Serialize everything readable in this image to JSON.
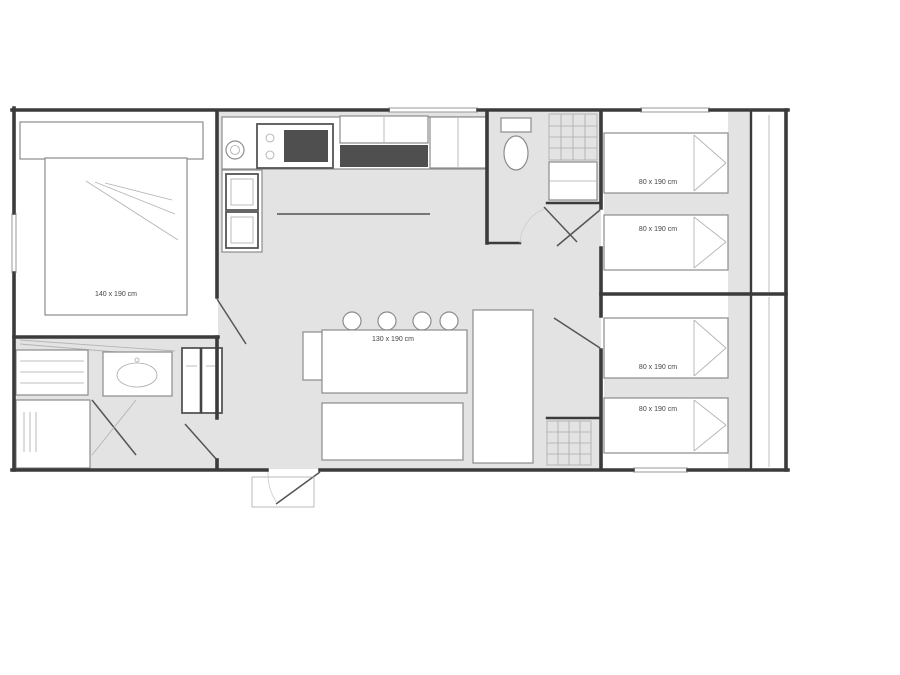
{
  "plan": {
    "type": "mobile-home floor plan",
    "colors": {
      "wall": "#3b3b3b",
      "floor": "#e3e3e3",
      "line": "#8c8c8c",
      "dark": "#4f4f4f",
      "text": "#444444",
      "background": "#ffffff"
    },
    "labels": {
      "master_bed": "140 x 190 cm",
      "bedroom2_bed_top": "80 x 190 cm",
      "bedroom2_bed_bottom": "80 x 190 cm",
      "bedroom3_bed_top": "80 x 190 cm",
      "bedroom3_bed_bottom": "80 x 190 cm",
      "dinette": "130 x 190 cm"
    }
  }
}
